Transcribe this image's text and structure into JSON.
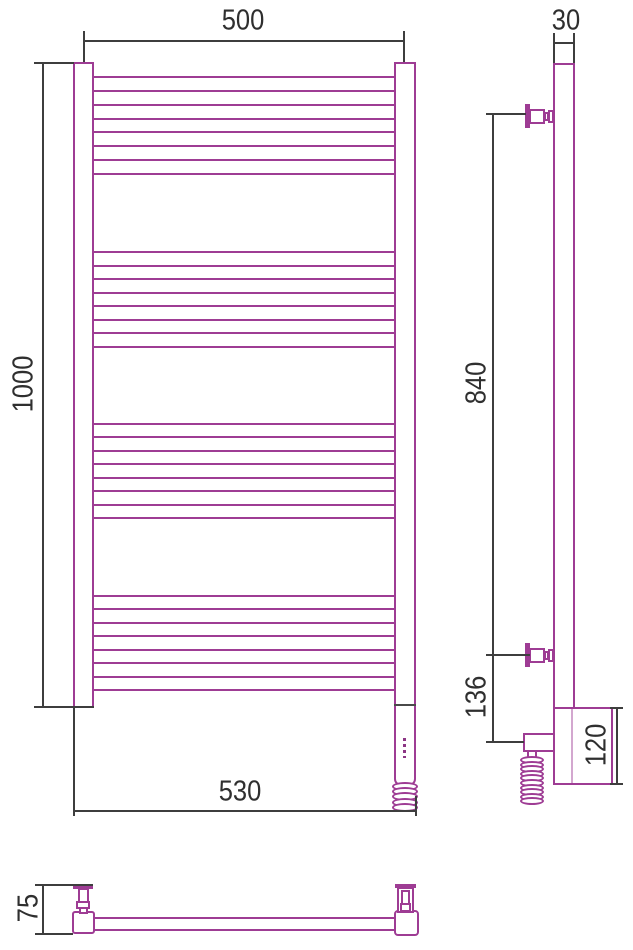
{
  "meta": {
    "drawing_type": "technical dimension drawing",
    "subject": "ladder towel radiator with electric heating element, three views"
  },
  "colors": {
    "radiator_outline": "#9e3c94",
    "dimension_lines": "#3e3e3e",
    "text": "#2f2f2f",
    "background": "#ffffff"
  },
  "dimensions": {
    "top_width": "500",
    "side_depth": "30",
    "overall_height": "1000",
    "bracket_spacing": "840",
    "bracket_to_outlet": "136",
    "heater_box_height": "120",
    "bottom_width": "530",
    "wall_offset": "75"
  },
  "structure": {
    "rung_groups": 4,
    "rungs_per_group": 8,
    "front_coil_loops": 5,
    "side_coil_loops": 10
  }
}
